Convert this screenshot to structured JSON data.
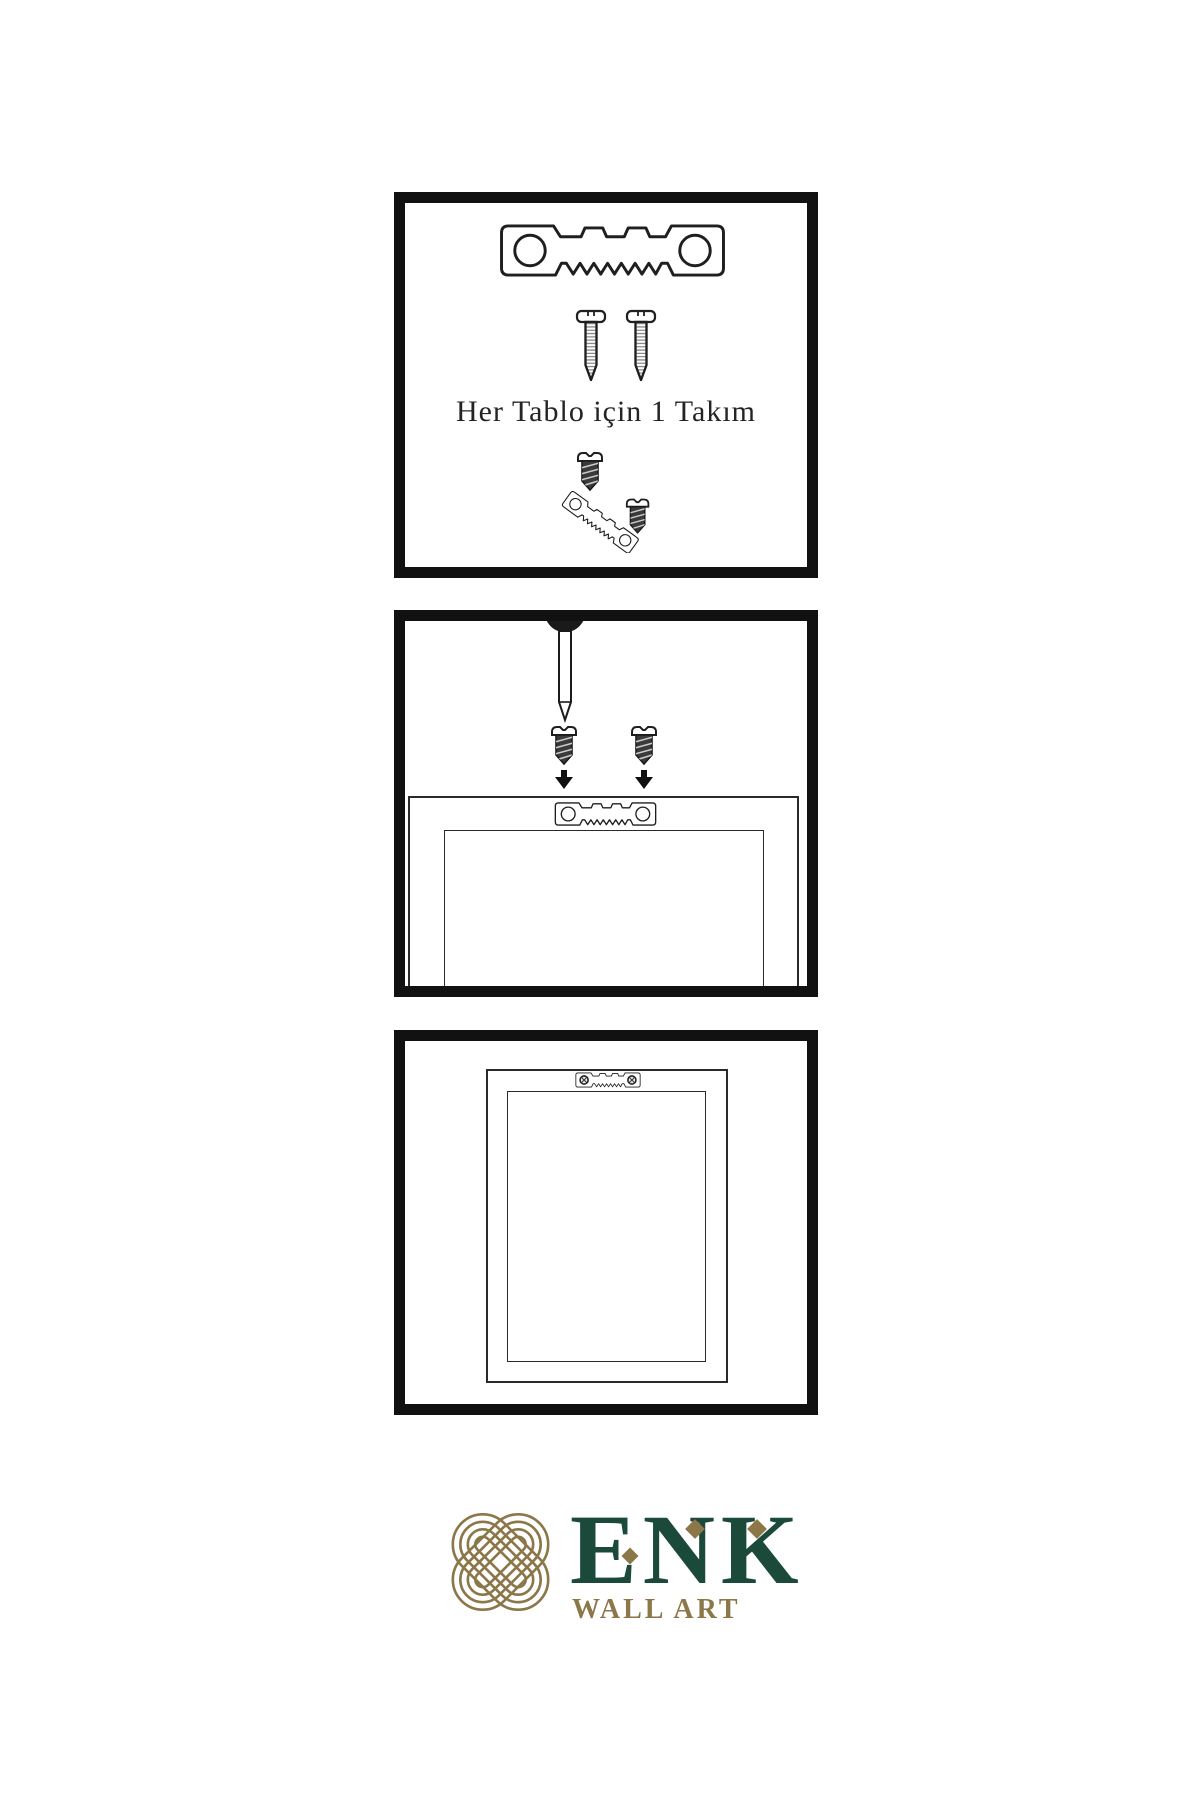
{
  "page": {
    "background_color": "#ffffff",
    "kind": "wall-art-hanging-instruction-sheet"
  },
  "instructions": {
    "steps": [
      {
        "name": "hardware-kit",
        "caption": "Her Tablo için 1 Takım",
        "items": [
          "sawtooth-hanger-icon",
          "screw-icon",
          "screw-icon",
          "screw-into-hanger-icon"
        ]
      },
      {
        "name": "attach-hanger-to-frame",
        "items": [
          "wall-nail-icon",
          "dark-screw-icon",
          "dark-screw-icon",
          "down-arrow-icon",
          "down-arrow-icon",
          "sawtooth-hanger-icon",
          "frame-back-icon"
        ]
      },
      {
        "name": "hang-frame-on-wall",
        "items": [
          "frame-back-icon",
          "mounted-hanger-with-screws-icon"
        ]
      }
    ]
  },
  "logo": {
    "brand": "ENK",
    "tagline": "WALL ART",
    "mark": "interlaced-knot-icon",
    "colors": {
      "gold": "#8B7748",
      "green": "#1B4A3B"
    }
  },
  "colors": {
    "ink": "#1a1a1a",
    "panel_border": "#111111"
  }
}
